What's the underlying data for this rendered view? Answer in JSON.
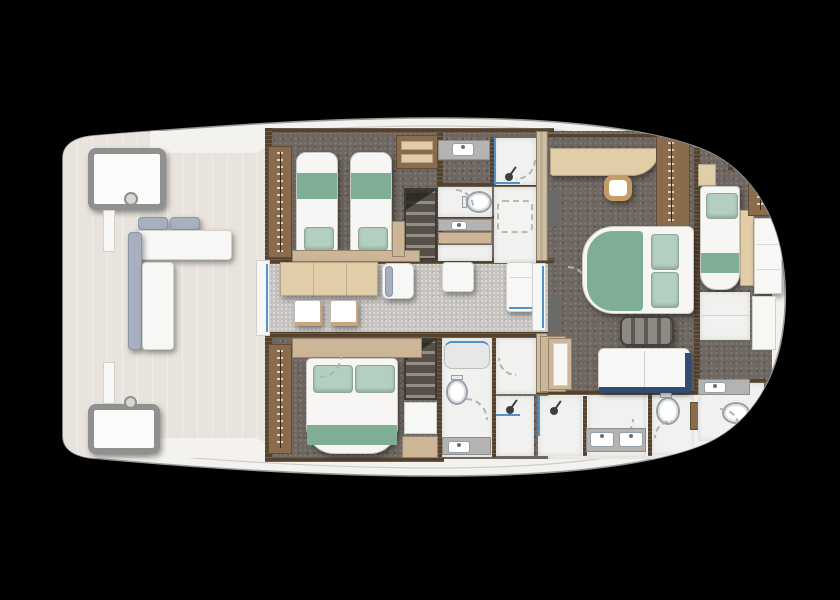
{
  "canvas": {
    "width": 840,
    "height": 600,
    "background": "#000000"
  },
  "palette": {
    "bg": "#000000",
    "hull-fill": "#f4f2ef",
    "hull-stroke": "#9c9a97",
    "hull-inner-line": "#cfccc8",
    "deck-floor": "#e8e4dd",
    "carpet": "#6e6660",
    "corridor-floor": "#c8c5c1",
    "bath-floor": "#f1f1ef",
    "wall-wood": "#54422f",
    "wood-mid": "#8a6c4c",
    "wood-light": "#cdb697",
    "wood-pale": "#e2cda9",
    "wall-pale-a": "#cdbfa4",
    "wall-pale-b": "#beae92",
    "bed-white": "#f7f6f4",
    "bed-green": "#7fae95",
    "pillow-green": "#b2cfbf",
    "cushion-gray": "#a6b0bf",
    "navy": "#2e4d70",
    "glass-blue": "#4f93c9",
    "fixture-stroke": "#97a0a6",
    "counter-gray": "#b4b3b1",
    "stair-dark": "#565049",
    "stair-light": "#938c84",
    "dark-trim": "#6a6a68"
  },
  "plan": {
    "type": "yacht-lower-deck-floor-plan",
    "orientation": "bow-right-stern-left",
    "rooms": [
      {
        "id": "aft-cockpit",
        "furniture": [
          "deck-locker-port",
          "deck-locker-starboard",
          "support-post-port",
          "support-post-starboard",
          "deck-fitting-port",
          "deck-fitting-starboard",
          "l-shaped-sofa",
          "sliding-glass-door"
        ]
      },
      {
        "id": "twin-guest-cabin",
        "furniture": [
          "wardrobe",
          "single-bed",
          "single-bed",
          "overhead-cabinet",
          "nightstand",
          "footboard-shelf"
        ]
      },
      {
        "id": "guest-day-bathroom",
        "furniture": [
          "vanity-sink",
          "shower",
          "toilet",
          "vanity",
          "dashed-shower-pan"
        ]
      },
      {
        "id": "forward-staircase",
        "furniture": [
          "stairs"
        ]
      },
      {
        "id": "passageway",
        "furniture": [
          "dinette-table",
          "stool",
          "stool",
          "chair",
          "white-cabinet",
          "tall-unit",
          "glass-door-to-master"
        ]
      },
      {
        "id": "vip-guest-cabin",
        "furniture": [
          "wardrobe",
          "double-bed",
          "headboard-shelf",
          "step-cabinet"
        ]
      },
      {
        "id": "aft-staircase",
        "furniture": [
          "stairs",
          "landing"
        ]
      },
      {
        "id": "vip-bathroom",
        "furniture": [
          "glass-shower",
          "toilet",
          "vanity-sink"
        ]
      },
      {
        "id": "mid-shower-rooms",
        "furniture": [
          "shower",
          "shower",
          "tall-wood-cabinet"
        ]
      },
      {
        "id": "master-cabin",
        "furniture": [
          "vanity-desk",
          "stool",
          "wardrobe",
          "double-bed",
          "cushion-bench",
          "sofa",
          "tv-cabinet"
        ]
      },
      {
        "id": "master-bathroom",
        "furniture": [
          "double-vanity",
          "toilet",
          "wood-cabinet"
        ]
      },
      {
        "id": "forward-cabin",
        "furniture": [
          "single-berth",
          "head-cabinet",
          "nightstand",
          "wardrobe",
          "bench-seat",
          "step-panels"
        ]
      },
      {
        "id": "forward-bathroom",
        "furniture": [
          "vanity-sink",
          "toilet"
        ]
      }
    ]
  }
}
